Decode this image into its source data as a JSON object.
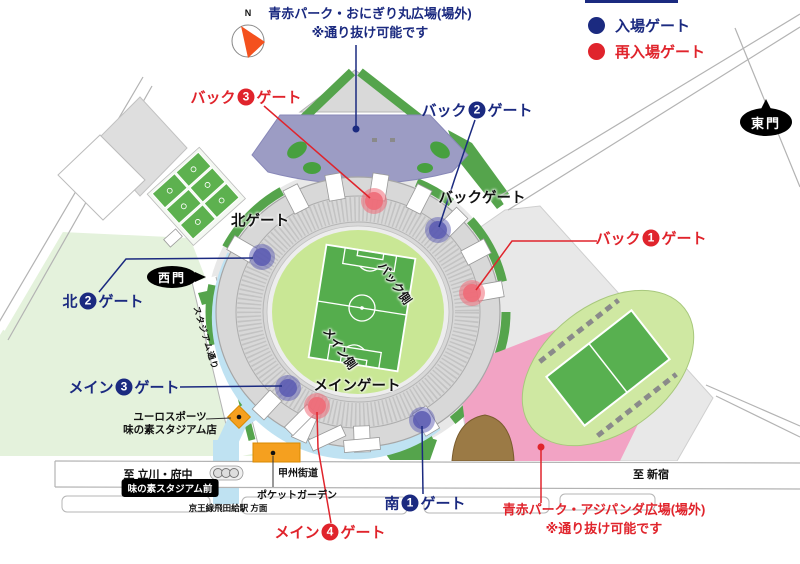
{
  "legend": {
    "entry_label": "入場ゲート",
    "reentry_label": "再入場ゲート",
    "entry_color": "#1b2a80",
    "reentry_color": "#e0242c"
  },
  "compass": {
    "north_label": "N"
  },
  "plazas": {
    "onigiri": {
      "line1": "青赤パーク・おにぎり丸広場(場外)",
      "line2": "※通り抜け可能です"
    },
    "ajipanda": {
      "line1": "青赤パーク・アジパンダ広場(場外)",
      "line2": "※通り抜け可能です"
    }
  },
  "gates": {
    "back3": {
      "prefix": "バック",
      "num": "3",
      "suffix": "ゲート",
      "type": "reentry"
    },
    "back2": {
      "prefix": "バック",
      "num": "2",
      "suffix": "ゲート",
      "type": "entry"
    },
    "back1": {
      "prefix": "バック",
      "num": "1",
      "suffix": "ゲート",
      "type": "reentry"
    },
    "kita2": {
      "prefix": "北",
      "num": "2",
      "suffix": "ゲート",
      "type": "entry"
    },
    "main3": {
      "prefix": "メイン",
      "num": "3",
      "suffix": "ゲート",
      "type": "entry"
    },
    "main4": {
      "prefix": "メイン",
      "num": "4",
      "suffix": "ゲート",
      "type": "reentry"
    },
    "minami1": {
      "prefix": "南",
      "num": "1",
      "suffix": "ゲート",
      "type": "entry"
    },
    "backgate": "バックゲート",
    "kitagate": "北ゲート",
    "maingate": "メインゲート"
  },
  "portals": {
    "nishimon": "西門",
    "higashimon": "東門"
  },
  "stadium": {
    "back_side": "バック側",
    "main_side": "メイン側"
  },
  "roads": {
    "koshu": "甲州街道",
    "to_tachikawa": "至 立川・府中",
    "to_shinjuku": "至 新宿",
    "stadium_street": "スタジアム通り"
  },
  "places": {
    "bus_stop": "味の素スタジアム前",
    "station_direction": "京王線飛田給駅 方面",
    "pocket_garden": "ポケットガーデン",
    "eurosport_line1": "ユーロスポーツ",
    "eurosport_line2": "味の素スタジアム店"
  },
  "colors": {
    "entry_gate_dot": "#5b5bb2",
    "reentry_gate_dot": "#ee6b78",
    "park_green": "#e4f2dc",
    "strip_green": "#55a44c",
    "pitch_green": "#55ad4d",
    "inner_field_green": "#c9e795",
    "plaza_purple": "#9c9cc4",
    "plaza_pink": "#f2a3c4",
    "mound_brown": "#9b7a45",
    "building_orange": "#f5a01f",
    "walkway_blue": "#bfe2f2",
    "pavement_grey": "#e8e8e8"
  }
}
